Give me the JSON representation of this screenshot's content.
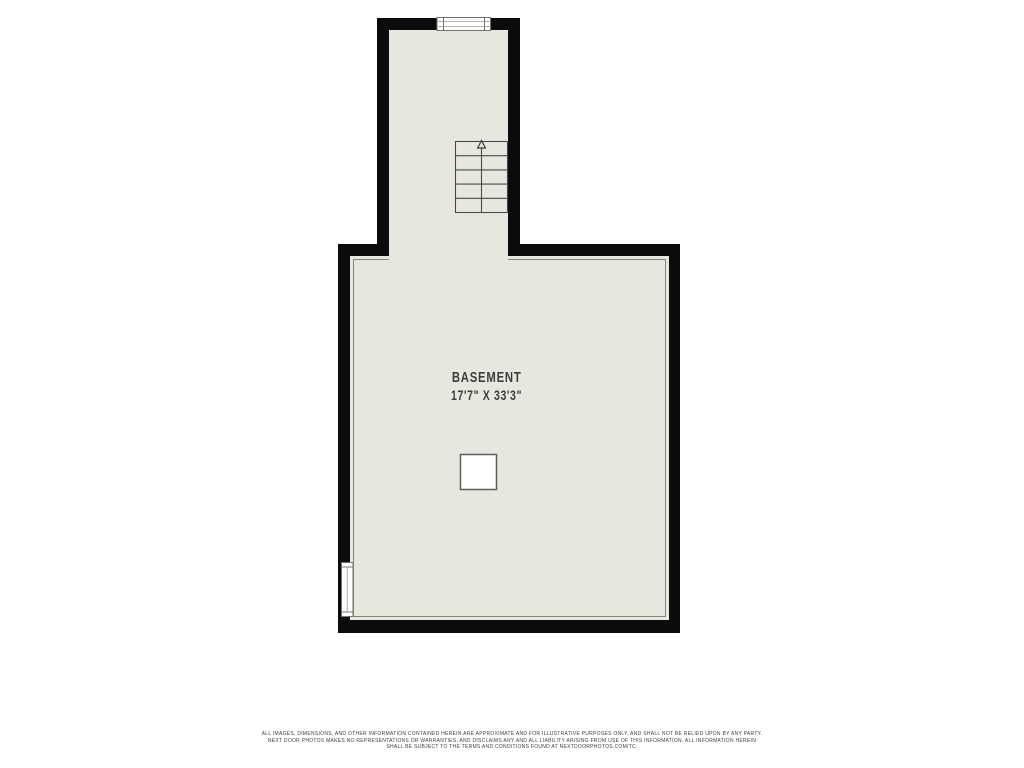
{
  "floor_plan": {
    "room_label": "BASEMENT",
    "room_dimensions": "17'7\" X 33'3\"",
    "stair_direction": "up",
    "features": [
      "staircase",
      "window-top",
      "window-left",
      "support-column"
    ]
  },
  "colors": {
    "wall": "#0b0b0b",
    "floor": "#e8e7df",
    "floor_outline": "#85857d",
    "symbol_stroke": "#4a4a4a",
    "window_stroke": "#74746e",
    "label_text": "#3d3d3d",
    "page_background": "#ffffff"
  },
  "disclaimer": {
    "line1": "ALL IMAGES, DIMENSIONS, AND OTHER INFORMATION CONTAINED HEREIN ARE APPROXIMATE AND FOR ILLUSTRATIVE PURPOSES ONLY, AND SHALL NOT BE RELIED UPON BY ANY PARTY.",
    "line2": "NEXT DOOR PHOTOS MAKES NO REPRESENTATIONS OR WARRANTIES, AND DISCLAIMS ANY AND ALL LIABILITY ARISING FROM USE OF THIS INFORMATION. ALL INFORMATION HEREIN",
    "line3": "SHALL BE SUBJECT TO THE TERMS AND CONDITIONS FOUND AT NEXTDOORPHOTOS.COM/TC."
  }
}
